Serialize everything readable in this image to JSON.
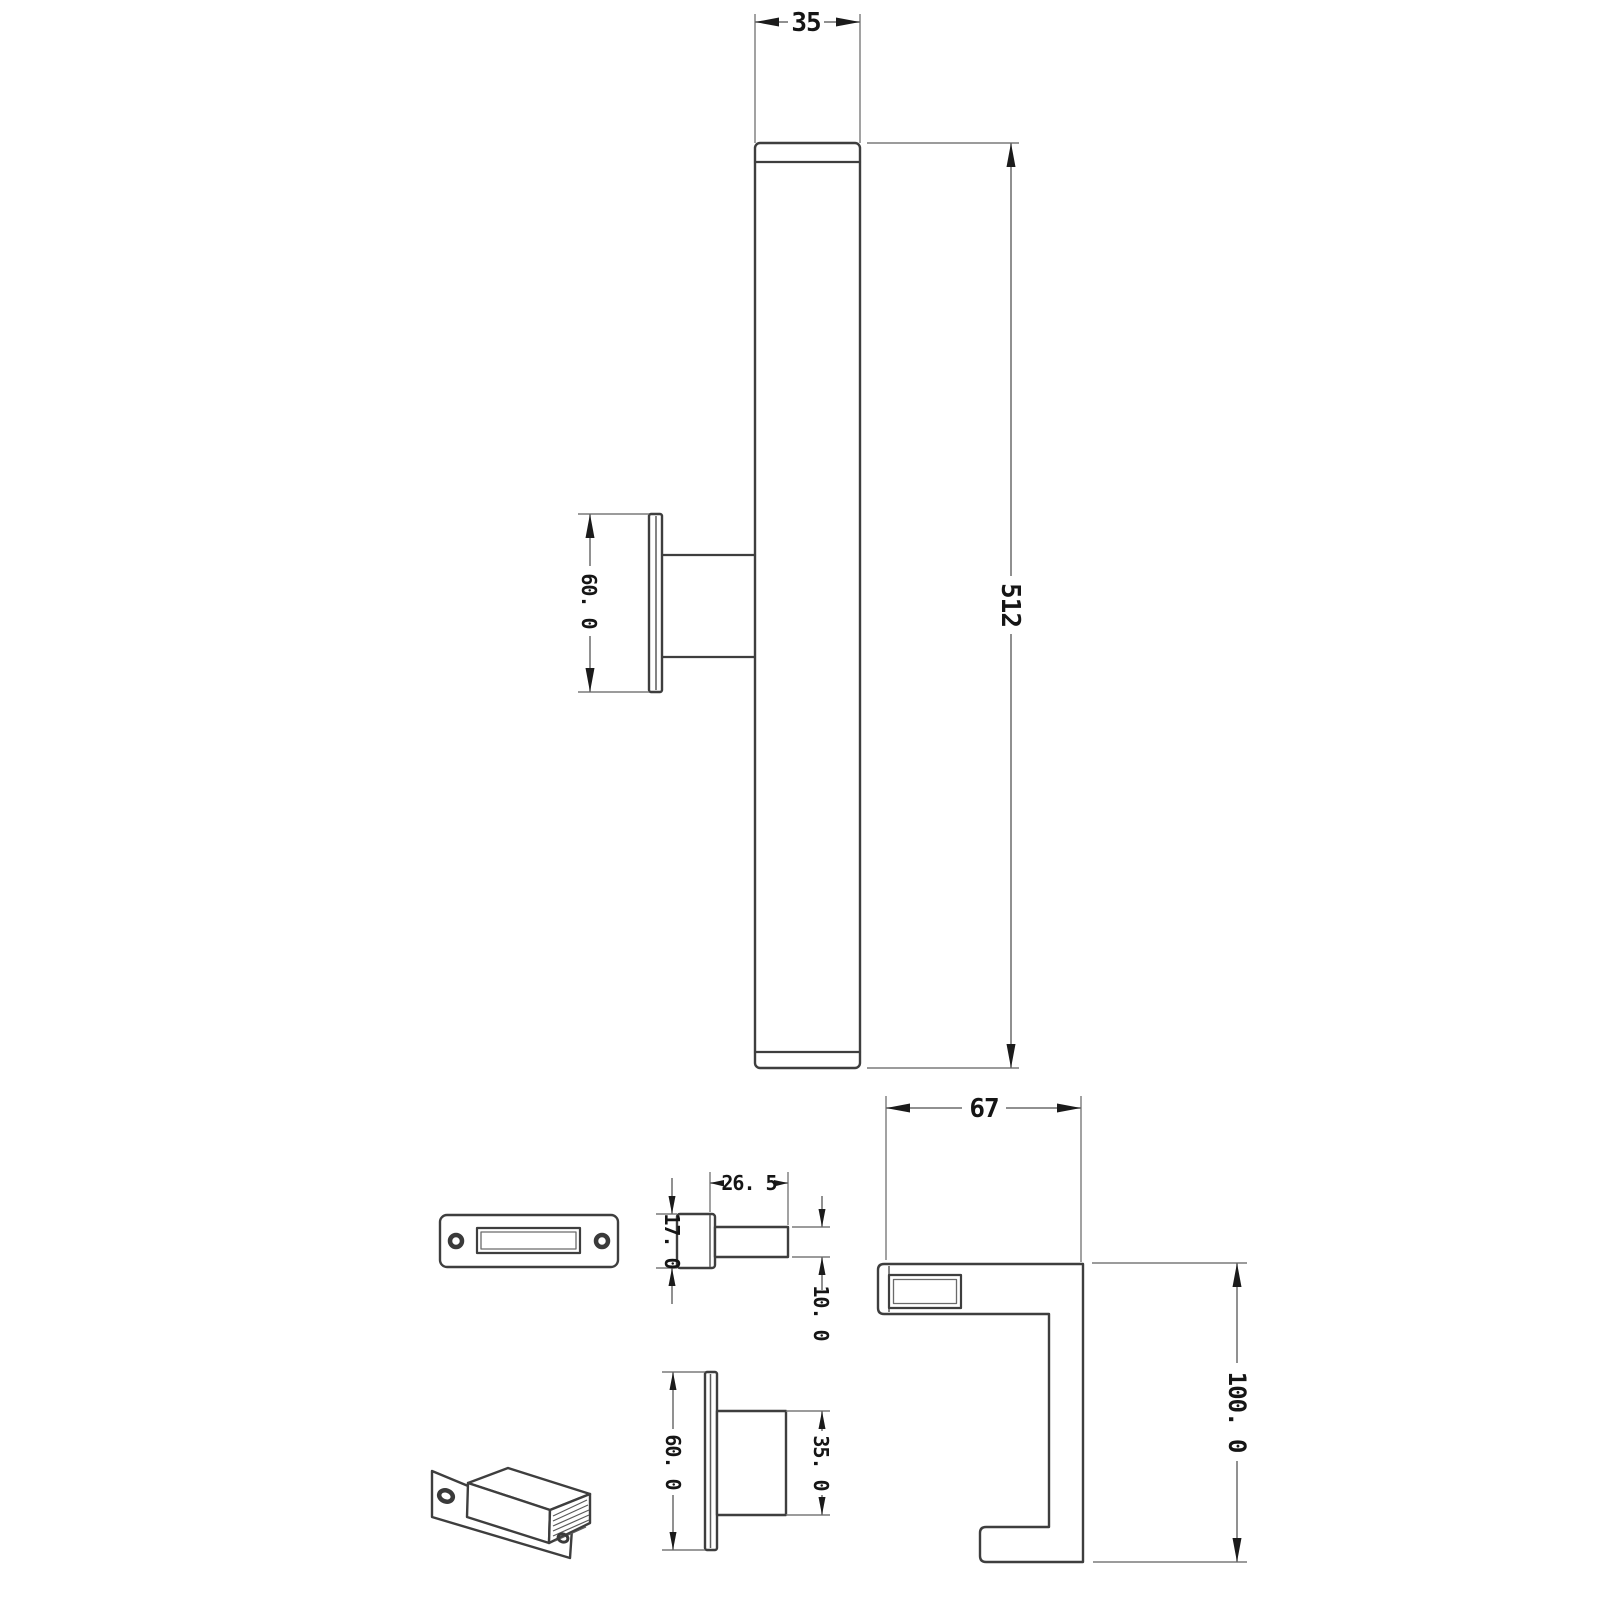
{
  "drawing": {
    "type": "technical-dimension-drawing",
    "subject": "wall-mounted LED mirror light fixture with mounting brackets",
    "background_color": "#ffffff",
    "colors": {
      "part_outline": "#3e3e3e",
      "dimension_line": "#6c6c6c",
      "extension_line": "#7a7a7a",
      "text_ink": "#151515"
    },
    "views": {
      "fixture_side": {
        "description": "front view of light bar with side-mounted bracket",
        "width_dim": "35",
        "length_dim": "512",
        "bracket_plate_height_dim": "60. 0"
      },
      "backplate_front": {
        "description": "front view of wall plate with two screw holes and slot"
      },
      "peg_detail": {
        "length_dim": "26. 5",
        "plate_height_dim": "17. 0",
        "peg_diameter_dim": "10. 0"
      },
      "mount_detail": {
        "plate_height_dim": "60. 0",
        "boss_diameter_dim": "35. 0"
      },
      "clamp_side": {
        "depth_dim": "67",
        "height_dim": "100. 0"
      },
      "iso_bracket": {
        "description": "isometric view of cabinet clamp bracket"
      }
    }
  }
}
